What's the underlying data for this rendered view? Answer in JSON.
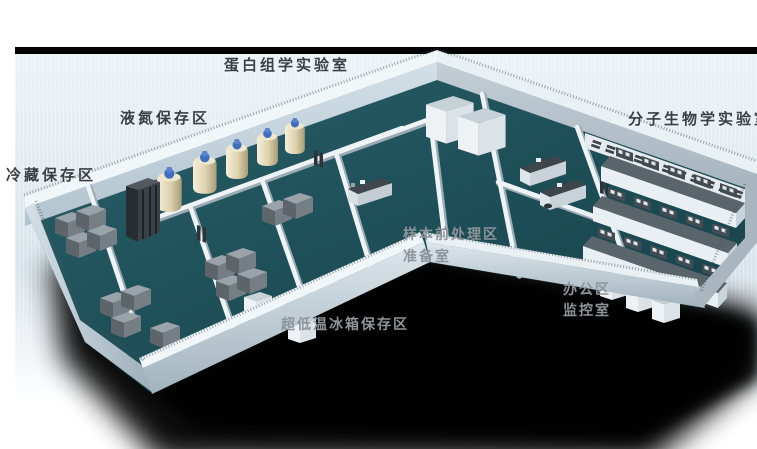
{
  "scene": {
    "description": "3D perspective rendering of a biobank laboratory floor plan",
    "background_color": "#ffffff",
    "panel": {
      "top_border_color": "#000000",
      "background_top": "#ecf3f7",
      "background_bottom": "#ffffff"
    },
    "render_colors": {
      "floor": "#1e4e57",
      "wall_top": "#f1f6f9",
      "wall_face": "#c6d4dd",
      "ground_shadow": "#000000",
      "ln2_tank_body": "#e9dfc2",
      "ln2_tank_cap": "#3e6ec0",
      "freezer": "#6e777d",
      "bench_top": "#5a646b"
    }
  },
  "labels": {
    "proteomics_lab": "蛋白组学实验室",
    "liquid_nitrogen_storage_area": "液氮保存区",
    "cold_storage_area": "冷藏保存区",
    "molecular_biology_lab": "分子生物学实验室",
    "sample_pretreatment_area": "样本前处理区",
    "preparation_room": "准备室",
    "office_area": "办公区",
    "monitoring_room": "监控室",
    "ult_freezer_storage_area": "超低温冰箱保存区"
  }
}
